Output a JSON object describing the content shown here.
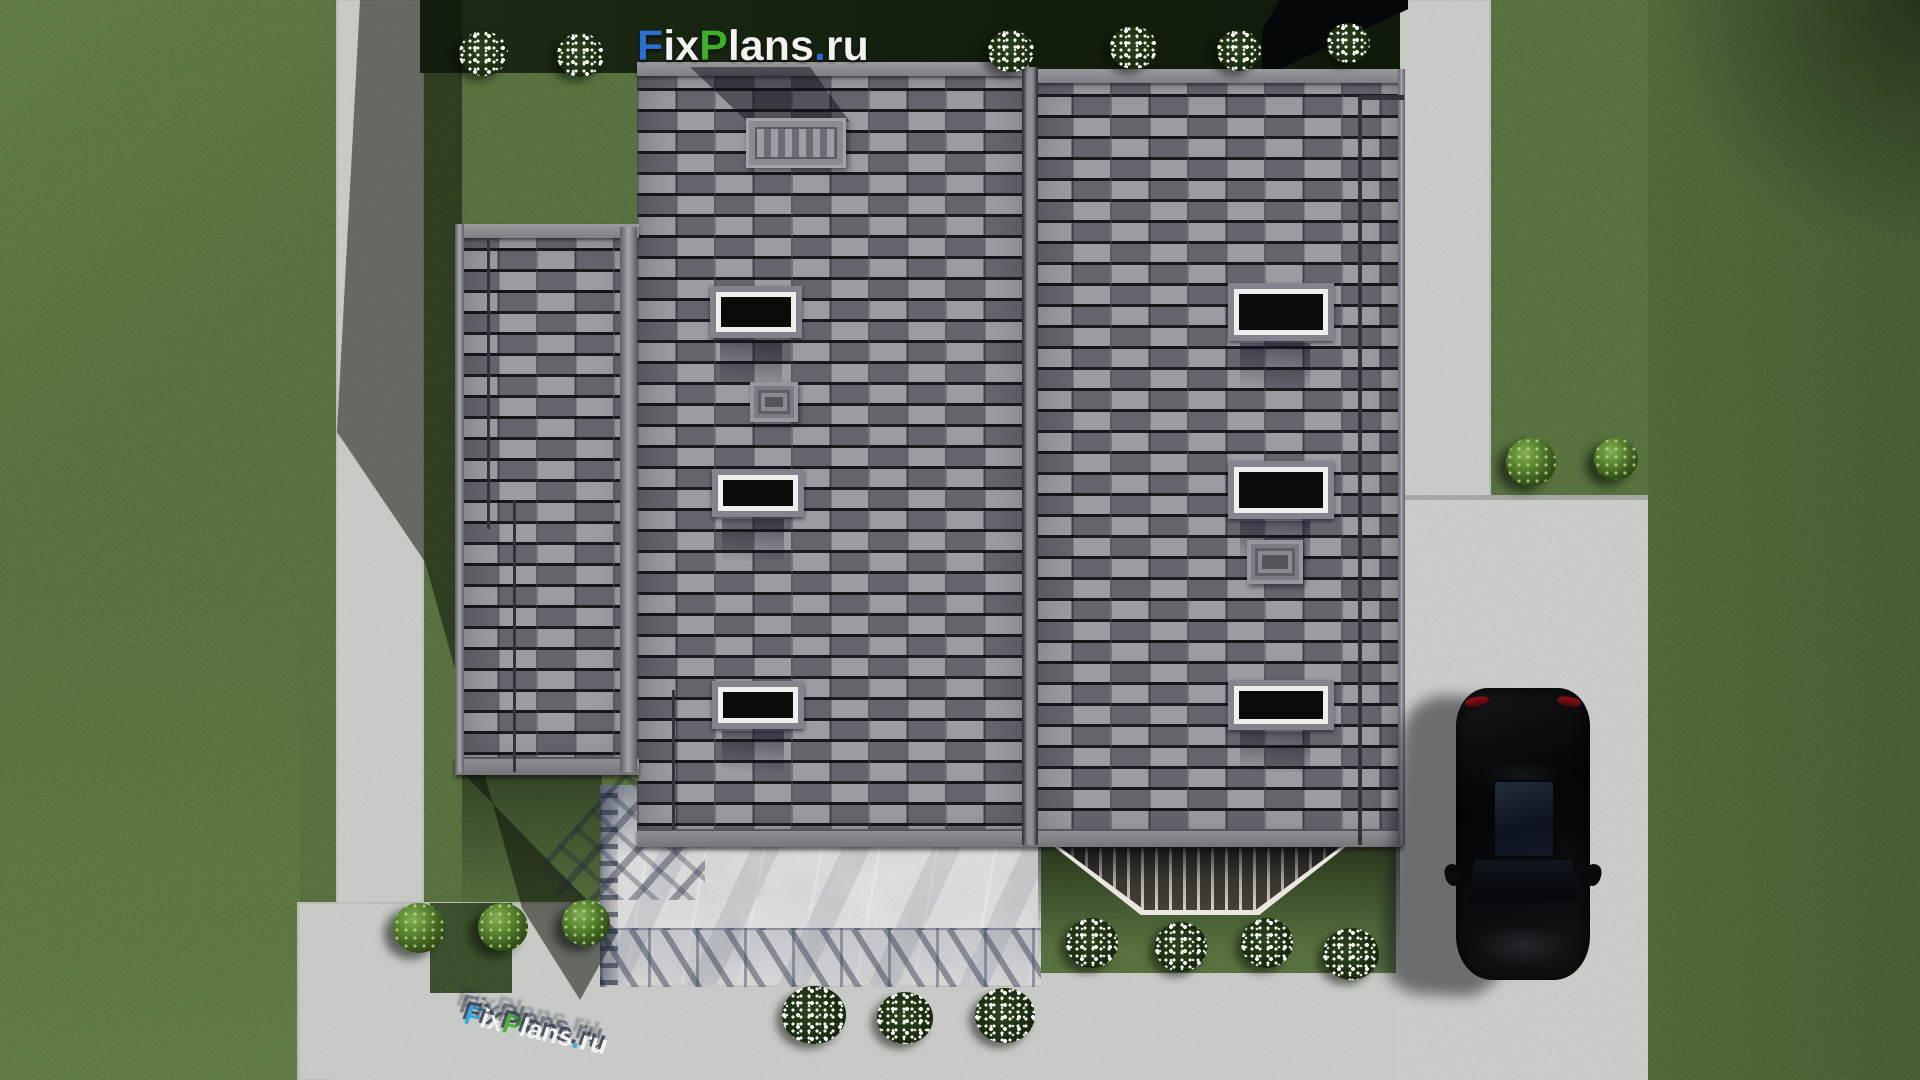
{
  "watermark": {
    "text": "FixPlans.ru",
    "segments": [
      {
        "text": "F",
        "color": "#2b6fd4"
      },
      {
        "text": "ix",
        "color": "#f3f3f1"
      },
      {
        "text": "P",
        "color": "#3fae2a"
      },
      {
        "text": "lans",
        "color": "#f3f3f1"
      },
      {
        "text": ".",
        "color": "#2b6fd4"
      },
      {
        "text": "ru",
        "color": "#f3f3f1"
      }
    ]
  },
  "ground_logo": {
    "text": "FixPlans.ru",
    "segments": [
      {
        "text": "F",
        "color": "#2da9e1"
      },
      {
        "text": "ix",
        "color": "#f6f6f4"
      },
      {
        "text": "P",
        "color": "#45b42e"
      },
      {
        "text": "lans",
        "color": "#f6f6f4"
      },
      {
        "text": ".",
        "color": "#2da9e1"
      },
      {
        "text": "ru",
        "color": "#f6f6f4"
      }
    ]
  },
  "palette": {
    "grass": "#4e6a33",
    "grass_shadow": "#16220f",
    "concrete": "#c9cbc7",
    "roof_tile_light": "#9b9ba1",
    "roof_tile_dark": "#65656e",
    "roof_gap": "#1f1f26",
    "eave": "#8e8e93",
    "patio_marble": "#e2e2e1",
    "car_body": "#0a0a0c",
    "skylight_frame": "#efefec",
    "skylight_glass": "#0b0b08",
    "porch_rail": "#ebe7e0"
  }
}
